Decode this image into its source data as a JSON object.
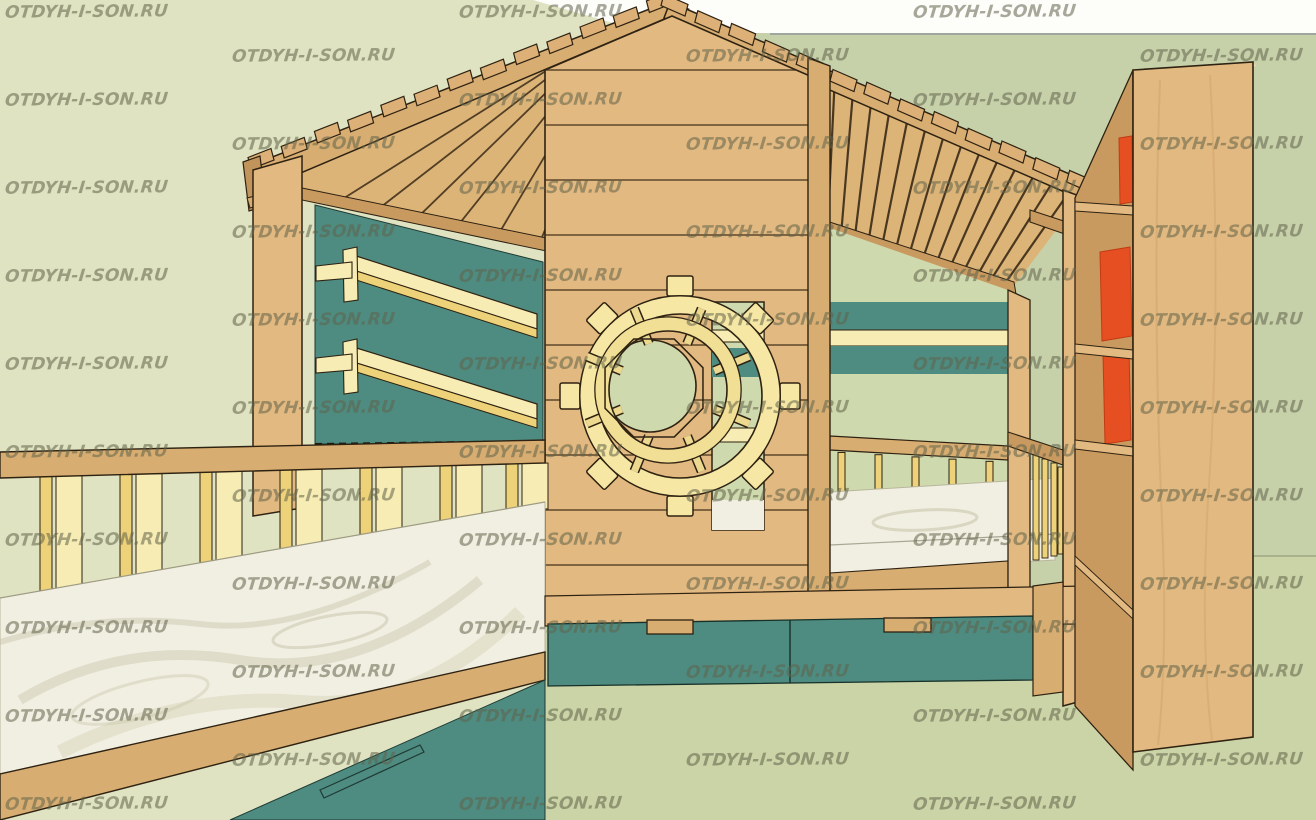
{
  "watermark": {
    "text": "OTDYH-I-SON.RU",
    "color": "rgba(96,98,72,0.55)",
    "grid": {
      "x_start": 5,
      "x_step": 227,
      "y_start": 2,
      "y_step": 44,
      "cols": 6,
      "rows": 19,
      "pattern": "checkerboard"
    }
  },
  "colors": {
    "sky_white": "#fdfdfa",
    "wall_green_light": "#dfe3c1",
    "wall_green_dark": "#c6d1aa",
    "floor_green": "#cbd4a6",
    "interior_green": "#cfd9ae",
    "teal": "#4e8b80",
    "teal_dark": "#3f7a6f",
    "wood": "#e2b981",
    "wood_light": "#e9c794",
    "wood_mid": "#d8ad72",
    "wood_dark": "#c89a60",
    "wood_deep": "#c1945c",
    "plank_line": "#3c2b17",
    "outline": "#2e2212",
    "shelf_cream": "#f7ecb4",
    "shelf_gold": "#eed27a",
    "wheel_cream": "#f6e7a4",
    "wheel_inner": "#f1df96",
    "book_red": "#e64f22",
    "book_red_dark": "#c03c14",
    "mattress": "#f1efe2",
    "mattress_swirl": "#c9c7ab",
    "horizon_line": "#9aa09c",
    "floor_line": "#a9b18d"
  }
}
